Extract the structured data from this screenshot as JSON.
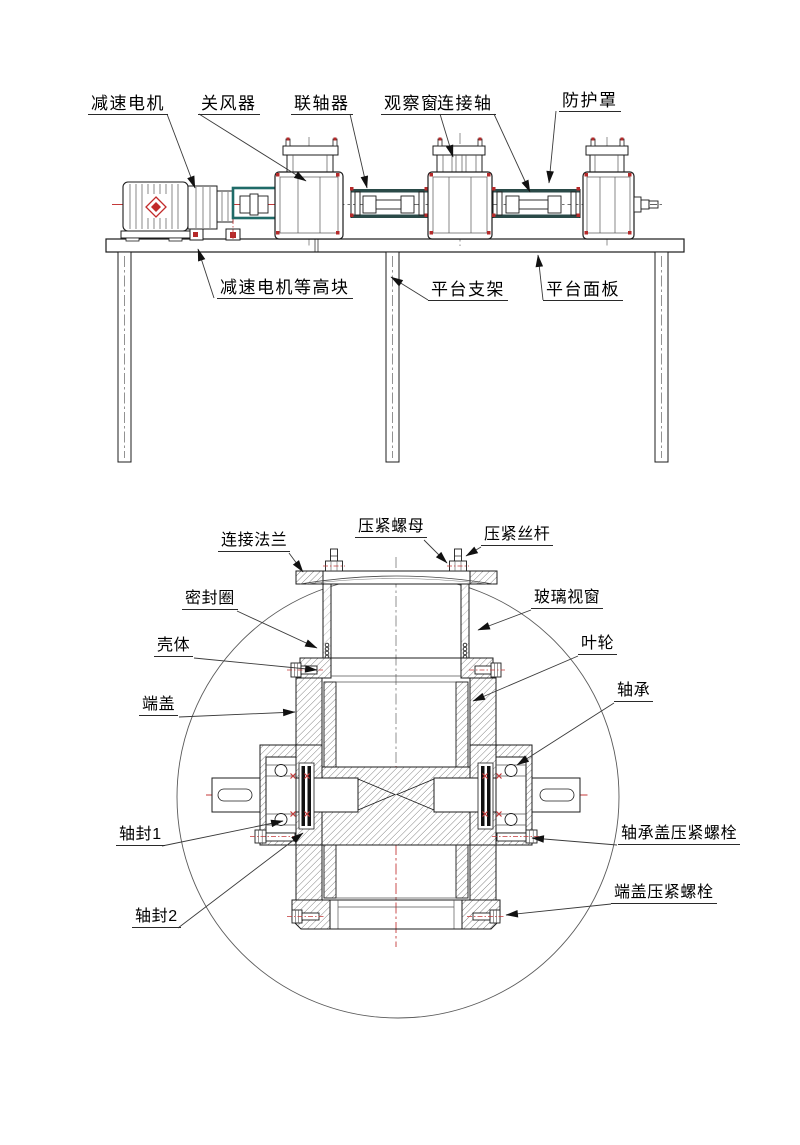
{
  "drawing_type": "mechanical engineering diagram (rotary airlock valve test platform, assembly view + sectional detail view)",
  "colors": {
    "line": "#1c1c1c",
    "centerline_red": "#c43a3a",
    "accent_teal": "#1f6b68",
    "bolt_marker_red": "#b52a2a",
    "hatch": "#5d5d5d",
    "leader": "#3a3a3a"
  },
  "assembly_view": {
    "part_labels": [
      "减速电机",
      "关风器",
      "联轴器",
      "观察窗",
      "连接轴",
      "防护罩"
    ],
    "platform_labels": [
      "减速电机等高块",
      "平台支架",
      "平台面板"
    ]
  },
  "section_view": {
    "part_labels": [
      "连接法兰",
      "压紧螺母",
      "压紧丝杆",
      "密封圈",
      "玻璃视窗",
      "壳体",
      "叶轮",
      "端盖",
      "轴承",
      "轴封1",
      "轴封2",
      "轴承盖压紧螺栓",
      "端盖压紧螺栓"
    ]
  }
}
